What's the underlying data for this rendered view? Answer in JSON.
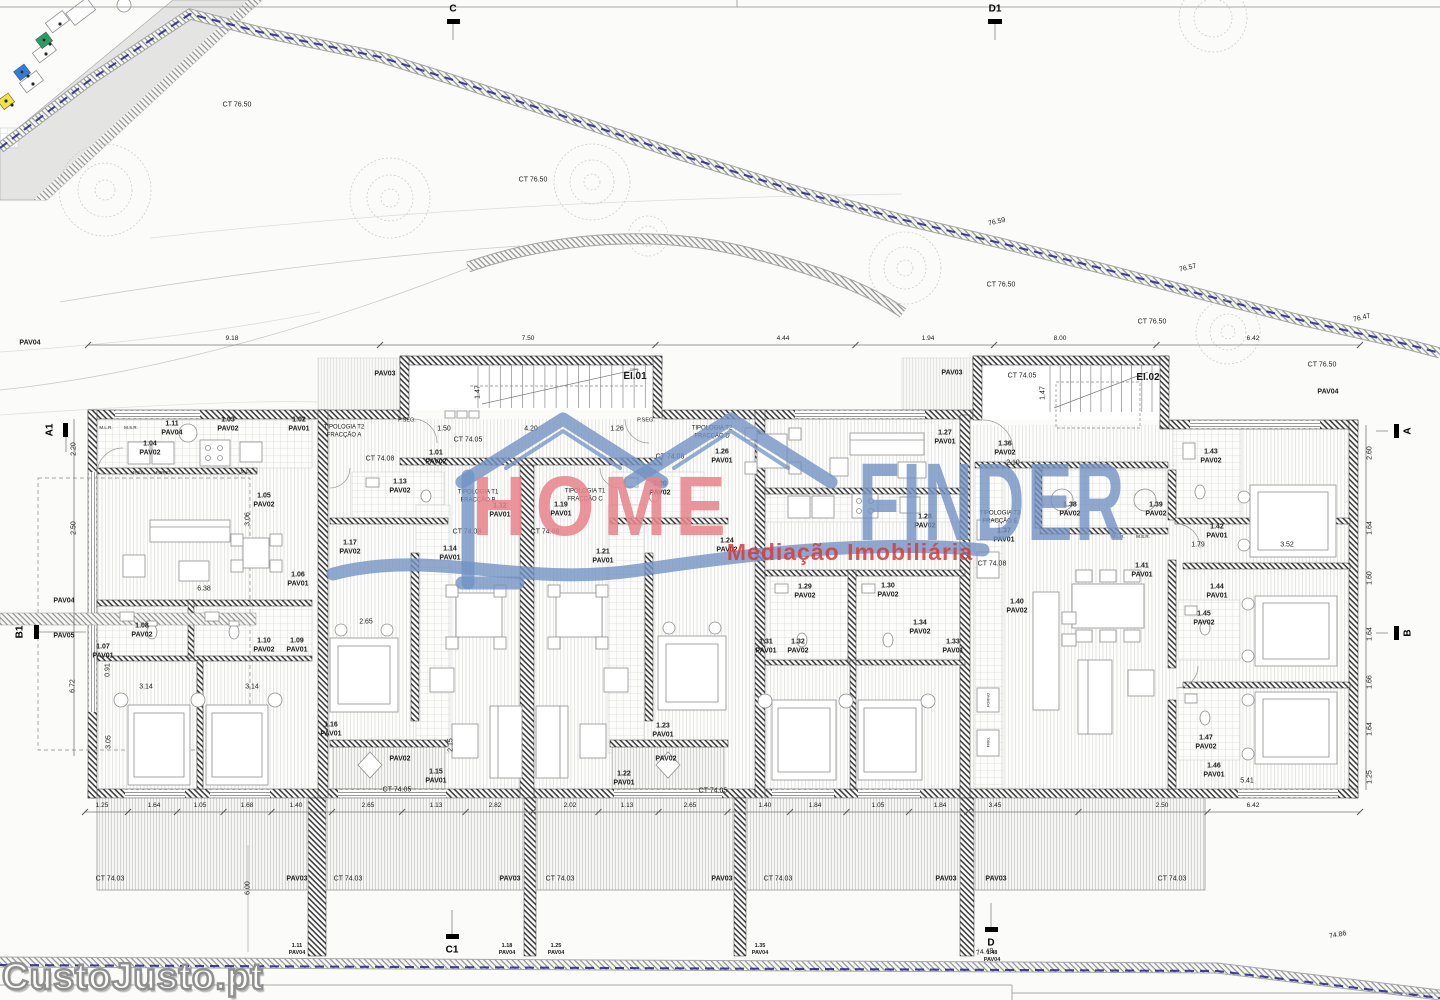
{
  "logo": {
    "home": "HOME",
    "finder": "FINDER",
    "tagline": "Mediação Imobiliária"
  },
  "watermark": {
    "site": "CustoJusto.pt"
  },
  "colors": {
    "logo_blue": "#7292c3",
    "logo_pink": "#e8838b",
    "logo_red": "#d93a3a",
    "boundary_blue": "#22228a",
    "bin_green": "#27a05f",
    "bin_blue": "#2d7ee0",
    "bin_yellow": "#f2e43c"
  },
  "plan": {
    "stair_cores": [
      {
        "id": "EI.01",
        "steps": 15
      },
      {
        "id": "EI.02",
        "steps": 16
      }
    ],
    "section_markers": [
      {
        "label": "C",
        "x": 453,
        "y": 9,
        "r": 0,
        "bar": [
          447,
          19,
          13,
          5
        ],
        "line": [
          453,
          24,
          453,
          40
        ]
      },
      {
        "label": "D1",
        "x": 995,
        "y": 9,
        "r": 0,
        "bar": [
          988,
          19,
          14,
          5
        ],
        "line": [
          995,
          24,
          995,
          40
        ]
      },
      {
        "label": "C1",
        "x": 452,
        "y": 950,
        "r": 0,
        "bar": [
          446,
          934,
          13,
          5
        ],
        "line": [
          452,
          910,
          452,
          934
        ]
      },
      {
        "label": "D",
        "x": 991,
        "y": 943,
        "r": 0,
        "bar": [
          985,
          927,
          13,
          5
        ],
        "line": [
          991,
          903,
          991,
          927
        ]
      },
      {
        "label": "A1",
        "x": 50,
        "y": 430,
        "r": -90,
        "bar": [
          63,
          423,
          5,
          14
        ],
        "line": [
          66,
          437,
          66,
          452
        ]
      },
      {
        "label": "B1",
        "x": 20,
        "y": 632,
        "r": -90,
        "bar": [
          34,
          625,
          5,
          14
        ],
        "line": [
          39,
          632,
          86,
          632
        ]
      },
      {
        "label": "A",
        "x": 1408,
        "y": 431,
        "r": -90,
        "bar": [
          1394,
          424,
          5,
          14
        ],
        "line": [
          1388,
          431,
          1376,
          431
        ]
      },
      {
        "label": "B",
        "x": 1408,
        "y": 633,
        "r": -90,
        "bar": [
          1394,
          626,
          5,
          14
        ],
        "line": [
          1388,
          633,
          1376,
          633
        ]
      }
    ],
    "dimension_lines": [
      {
        "y": 345,
        "x0": 88,
        "x1": 1360,
        "entries": [
          {
            "v": "9.18",
            "x": 232
          },
          {
            "v": "7.50",
            "x": 528
          },
          {
            "v": "4.44",
            "x": 783
          },
          {
            "v": "1.94",
            "x": 928
          },
          {
            "v": "8.00",
            "x": 1060
          },
          {
            "v": "6.42",
            "x": 1253
          }
        ]
      },
      {
        "y": 812,
        "x0": 85,
        "x1": 1360,
        "entries": [
          {
            "v": "1.25",
            "x": 102
          },
          {
            "v": "1.64",
            "x": 154
          },
          {
            "v": "1.05",
            "x": 200
          },
          {
            "v": "1.68",
            "x": 247
          },
          {
            "v": "1.40",
            "x": 296
          },
          {
            "v": "2.65",
            "x": 368
          },
          {
            "v": "1.13",
            "x": 436
          },
          {
            "v": "2.82",
            "x": 495
          },
          {
            "v": "2.02",
            "x": 570
          },
          {
            "v": "1.13",
            "x": 627
          },
          {
            "v": "2.65",
            "x": 690
          },
          {
            "v": "1.40",
            "x": 765
          },
          {
            "v": "1.84",
            "x": 815
          },
          {
            "v": "1.05",
            "x": 878
          },
          {
            "v": "1.84",
            "x": 940
          },
          {
            "v": "3.45",
            "x": 995
          },
          {
            "v": "2.50",
            "x": 1162
          },
          {
            "v": "6.42",
            "x": 1253
          }
        ]
      }
    ],
    "labels": [
      {
        "t": "CT 76.50",
        "x": 237,
        "y": 106
      },
      {
        "t": "CT 76.50",
        "x": 533,
        "y": 181
      },
      {
        "t": "CT 76.50",
        "x": 1001,
        "y": 286
      },
      {
        "t": "CT 76.50",
        "x": 1152,
        "y": 323
      },
      {
        "t": "CT 76.50",
        "x": 1322,
        "y": 366
      },
      {
        "t": "76.59",
        "x": 997,
        "y": 223,
        "r": -13
      },
      {
        "t": "76.57",
        "x": 1188,
        "y": 269,
        "r": -13
      },
      {
        "t": "76.47",
        "x": 1362,
        "y": 319,
        "r": -13
      },
      {
        "t": "74.86",
        "x": 1338,
        "y": 936,
        "r": -10
      },
      {
        "t": "74.48",
        "x": 985,
        "y": 953,
        "r": -8
      },
      {
        "t": "PAV04",
        "x": 30,
        "y": 344,
        "b": 1
      },
      {
        "t": "PAV04",
        "x": 1328,
        "y": 393,
        "b": 1
      },
      {
        "t": "PAV03",
        "x": 385,
        "y": 375,
        "b": 1
      },
      {
        "t": "PAV03",
        "x": 952,
        "y": 374,
        "b": 1
      },
      {
        "t": "PAV04",
        "x": 64,
        "y": 602,
        "b": 1
      },
      {
        "t": "PAV05",
        "x": 64,
        "y": 637,
        "b": 1
      },
      {
        "t": "EI.01",
        "x": 635,
        "y": 377,
        "b": 1,
        "fs": 10
      },
      {
        "t": "EI.02",
        "x": 1148,
        "y": 378,
        "b": 1,
        "fs": 10
      },
      {
        "t": "CT 74.05",
        "x": 468,
        "y": 441
      },
      {
        "t": "CT 74.05",
        "x": 1022,
        "y": 377
      },
      {
        "t": "CT 74.08",
        "x": 380,
        "y": 460
      },
      {
        "t": "CT 74.08",
        "x": 467,
        "y": 533
      },
      {
        "t": "CT 74.08",
        "x": 545,
        "y": 533
      },
      {
        "t": "CT 74.08",
        "x": 670,
        "y": 458
      },
      {
        "t": "CT 74.08",
        "x": 992,
        "y": 565
      },
      {
        "t": "CT 74.05",
        "x": 397,
        "y": 791
      },
      {
        "t": "CT 74.05",
        "x": 713,
        "y": 792
      },
      {
        "t": "1.11\nPAV04",
        "x": 172,
        "y": 429,
        "b": 1
      },
      {
        "t": "1.04\nPAV02",
        "x": 150,
        "y": 449,
        "b": 1
      },
      {
        "t": "1.03\nPAV02",
        "x": 228,
        "y": 425,
        "b": 1
      },
      {
        "t": "1.02\nPAV01",
        "x": 299,
        "y": 425,
        "b": 1
      },
      {
        "t": "TIPOLOGIA T2\nFRACÇÃO A",
        "x": 344,
        "y": 432,
        "fs": 6
      },
      {
        "t": "P.SEG.",
        "x": 407,
        "y": 421,
        "fs": 5.5
      },
      {
        "t": "P.SEG.",
        "x": 646,
        "y": 421,
        "fs": 5.5
      },
      {
        "t": "1.01\nPAV02",
        "x": 436,
        "y": 458,
        "b": 1
      },
      {
        "t": "1.05\nPAV02",
        "x": 264,
        "y": 501,
        "b": 1
      },
      {
        "t": "1.06\nPAV01",
        "x": 298,
        "y": 580,
        "b": 1
      },
      {
        "t": "1.07\nPAV01",
        "x": 103,
        "y": 652,
        "b": 1
      },
      {
        "t": "1.08\nPAV02",
        "x": 142,
        "y": 631,
        "b": 1
      },
      {
        "t": "1.10\nPAV02",
        "x": 264,
        "y": 646,
        "b": 1
      },
      {
        "t": "1.09\nPAV01",
        "x": 297,
        "y": 646,
        "b": 1
      },
      {
        "t": "1.13\nPAV02",
        "x": 400,
        "y": 487,
        "b": 1
      },
      {
        "t": "TIPOLOGIA T1\nFRACÇÃO B",
        "x": 478,
        "y": 497,
        "fs": 6
      },
      {
        "t": "1.12\nPAV01",
        "x": 500,
        "y": 511,
        "b": 1
      },
      {
        "t": "1.17\nPAV02",
        "x": 350,
        "y": 548,
        "b": 1
      },
      {
        "t": "1.14\nPAV01",
        "x": 450,
        "y": 554,
        "b": 1
      },
      {
        "t": "1.16\nPAV01",
        "x": 331,
        "y": 730,
        "b": 1
      },
      {
        "t": "1.15\nPAV01",
        "x": 436,
        "y": 777,
        "b": 1
      },
      {
        "t": "PAV02",
        "x": 400,
        "y": 760,
        "b": 1
      },
      {
        "t": "1.19\nPAV01",
        "x": 561,
        "y": 510,
        "b": 1
      },
      {
        "t": "TIPOLOGIA T1\nFRACÇÃO C",
        "x": 585,
        "y": 496,
        "fs": 6
      },
      {
        "t": "1.20\nPAV02",
        "x": 660,
        "y": 489,
        "b": 1
      },
      {
        "t": "1.21\nPAV01",
        "x": 603,
        "y": 557,
        "b": 1
      },
      {
        "t": "1.24\nPAV02",
        "x": 727,
        "y": 546,
        "b": 1
      },
      {
        "t": "1.23\nPAV01",
        "x": 663,
        "y": 731,
        "b": 1
      },
      {
        "t": "1.22\nPAV01",
        "x": 624,
        "y": 779,
        "b": 1
      },
      {
        "t": "PAV02",
        "x": 666,
        "y": 760,
        "b": 1
      },
      {
        "t": "TIPOLOGIA T2\nFRACÇÃO D",
        "x": 712,
        "y": 433,
        "fs": 6
      },
      {
        "t": "1.26\nPAV01",
        "x": 722,
        "y": 457,
        "b": 1
      },
      {
        "t": "1.27\nPAV01",
        "x": 945,
        "y": 438,
        "b": 1
      },
      {
        "t": "1.28\nPAV02",
        "x": 925,
        "y": 522,
        "b": 1
      },
      {
        "t": "1.29\nPAV02",
        "x": 805,
        "y": 592,
        "b": 1
      },
      {
        "t": "1.30\nPAV02",
        "x": 888,
        "y": 591,
        "b": 1
      },
      {
        "t": "1.31\nPAV01",
        "x": 766,
        "y": 647,
        "b": 1
      },
      {
        "t": "1.32\nPAV02",
        "x": 798,
        "y": 647,
        "b": 1
      },
      {
        "t": "1.34\nPAV02",
        "x": 920,
        "y": 628,
        "b": 1
      },
      {
        "t": "1.33\nPAV01",
        "x": 953,
        "y": 647,
        "b": 1
      },
      {
        "t": "1.36\nPAV02",
        "x": 1005,
        "y": 449,
        "b": 1
      },
      {
        "t": "2.10",
        "x": 1013,
        "y": 464
      },
      {
        "t": "TIPOLOGIA T3\nFRACÇÃO E",
        "x": 1000,
        "y": 518,
        "fs": 6
      },
      {
        "t": "1.37\nPAV01",
        "x": 1004,
        "y": 536,
        "b": 1
      },
      {
        "t": "1.38\nPAV02",
        "x": 1070,
        "y": 510,
        "b": 1
      },
      {
        "t": "1.39\nPAV02",
        "x": 1156,
        "y": 510,
        "b": 1
      },
      {
        "t": "1.43\nPAV02",
        "x": 1211,
        "y": 457,
        "b": 1
      },
      {
        "t": "1.42\nPAV01",
        "x": 1217,
        "y": 532,
        "b": 1
      },
      {
        "t": "1.41\nPAV01",
        "x": 1142,
        "y": 571,
        "b": 1
      },
      {
        "t": "1.40\nPAV02",
        "x": 1017,
        "y": 607,
        "b": 1
      },
      {
        "t": "1.44\nPAV01",
        "x": 1217,
        "y": 592,
        "b": 1
      },
      {
        "t": "1.45\nPAV02",
        "x": 1204,
        "y": 619,
        "b": 1
      },
      {
        "t": "1.47\nPAV02",
        "x": 1206,
        "y": 743,
        "b": 1
      },
      {
        "t": "1.46\nPAV01",
        "x": 1214,
        "y": 771,
        "b": 1
      },
      {
        "t": "1.48\nPAV04",
        "x": 992,
        "y": 957,
        "b": 1,
        "fs": 5.5
      },
      {
        "t": "CT 74.03",
        "x": 110,
        "y": 880
      },
      {
        "t": "PAV03",
        "x": 297,
        "y": 880,
        "b": 1
      },
      {
        "t": "CT 74.03",
        "x": 348,
        "y": 880
      },
      {
        "t": "PAV03",
        "x": 510,
        "y": 880,
        "b": 1
      },
      {
        "t": "CT 74.03",
        "x": 560,
        "y": 880
      },
      {
        "t": "PAV03",
        "x": 722,
        "y": 880,
        "b": 1
      },
      {
        "t": "CT 74.03",
        "x": 778,
        "y": 880
      },
      {
        "t": "PAV03",
        "x": 946,
        "y": 880,
        "b": 1
      },
      {
        "t": "PAV03",
        "x": 996,
        "y": 880,
        "b": 1
      },
      {
        "t": "CT 74.03",
        "x": 1172,
        "y": 880
      },
      {
        "t": "1.11\nPAV04",
        "x": 297,
        "y": 950,
        "b": 1,
        "fs": 5.5
      },
      {
        "t": "1.18\nPAV04",
        "x": 507,
        "y": 950,
        "b": 1,
        "fs": 5.5
      },
      {
        "t": "1.25\nPAV04",
        "x": 556,
        "y": 950,
        "b": 1,
        "fs": 5.5
      },
      {
        "t": "1.35\nPAV04",
        "x": 760,
        "y": 950,
        "b": 1,
        "fs": 5.5
      },
      {
        "t": "M.L.R.",
        "x": 106,
        "y": 428,
        "fs": 4.5
      },
      {
        "t": "M.S.R.",
        "x": 131,
        "y": 428,
        "fs": 4.5
      },
      {
        "t": "FRIG.",
        "x": 138,
        "y": 472,
        "fs": 4
      },
      {
        "t": "FORNO",
        "x": 163,
        "y": 472,
        "fs": 4
      },
      {
        "t": "M.L.L.",
        "x": 247,
        "y": 472,
        "fs": 4.5
      },
      {
        "t": "M.L.R.",
        "x": 1118,
        "y": 537,
        "fs": 4.5
      },
      {
        "t": "M.S.R.",
        "x": 1143,
        "y": 537,
        "fs": 4.5
      },
      {
        "t": "FORNO",
        "x": 988,
        "y": 700,
        "fs": 4,
        "r": -90
      },
      {
        "t": "FRIG.",
        "x": 988,
        "y": 742,
        "fs": 4,
        "r": -90
      },
      {
        "t": "2.20",
        "x": 75,
        "y": 449,
        "r": -90
      },
      {
        "t": "2.50",
        "x": 75,
        "y": 528,
        "r": -90
      },
      {
        "t": "6.72",
        "x": 74,
        "y": 686,
        "r": -90
      },
      {
        "t": "0.91",
        "x": 109,
        "y": 670,
        "r": -90
      },
      {
        "t": "3.05",
        "x": 110,
        "y": 742,
        "r": -90
      },
      {
        "t": "3.14",
        "x": 146,
        "y": 688
      },
      {
        "t": "3.14",
        "x": 252,
        "y": 688
      },
      {
        "t": "6.38",
        "x": 204,
        "y": 590
      },
      {
        "t": "3.06",
        "x": 249,
        "y": 519,
        "r": -90
      },
      {
        "t": "2.65",
        "x": 366,
        "y": 623
      },
      {
        "t": "1.50",
        "x": 444,
        "y": 430
      },
      {
        "t": "4.20",
        "x": 531,
        "y": 430
      },
      {
        "t": "1.26",
        "x": 617,
        "y": 430
      },
      {
        "t": "1.47",
        "x": 479,
        "y": 392,
        "r": -90
      },
      {
        "t": "1.47",
        "x": 1044,
        "y": 393,
        "r": -90
      },
      {
        "t": "1.79",
        "x": 1198,
        "y": 546
      },
      {
        "t": "3.52",
        "x": 1287,
        "y": 546
      },
      {
        "t": "5.41",
        "x": 1247,
        "y": 782
      },
      {
        "t": "6.00",
        "x": 249,
        "y": 888,
        "r": -90
      },
      {
        "t": "2.15",
        "x": 452,
        "y": 745,
        "r": -90
      },
      {
        "t": "2.60",
        "x": 1371,
        "y": 453,
        "r": -90
      },
      {
        "t": "1.64",
        "x": 1371,
        "y": 528,
        "r": -90
      },
      {
        "t": "1.60",
        "x": 1371,
        "y": 578,
        "r": -90
      },
      {
        "t": "1.64",
        "x": 1371,
        "y": 634,
        "r": -90
      },
      {
        "t": "1.66",
        "x": 1371,
        "y": 682,
        "r": -90
      },
      {
        "t": "1.64",
        "x": 1371,
        "y": 729,
        "r": -90
      },
      {
        "t": "1.25",
        "x": 1371,
        "y": 777,
        "r": -90
      }
    ]
  }
}
